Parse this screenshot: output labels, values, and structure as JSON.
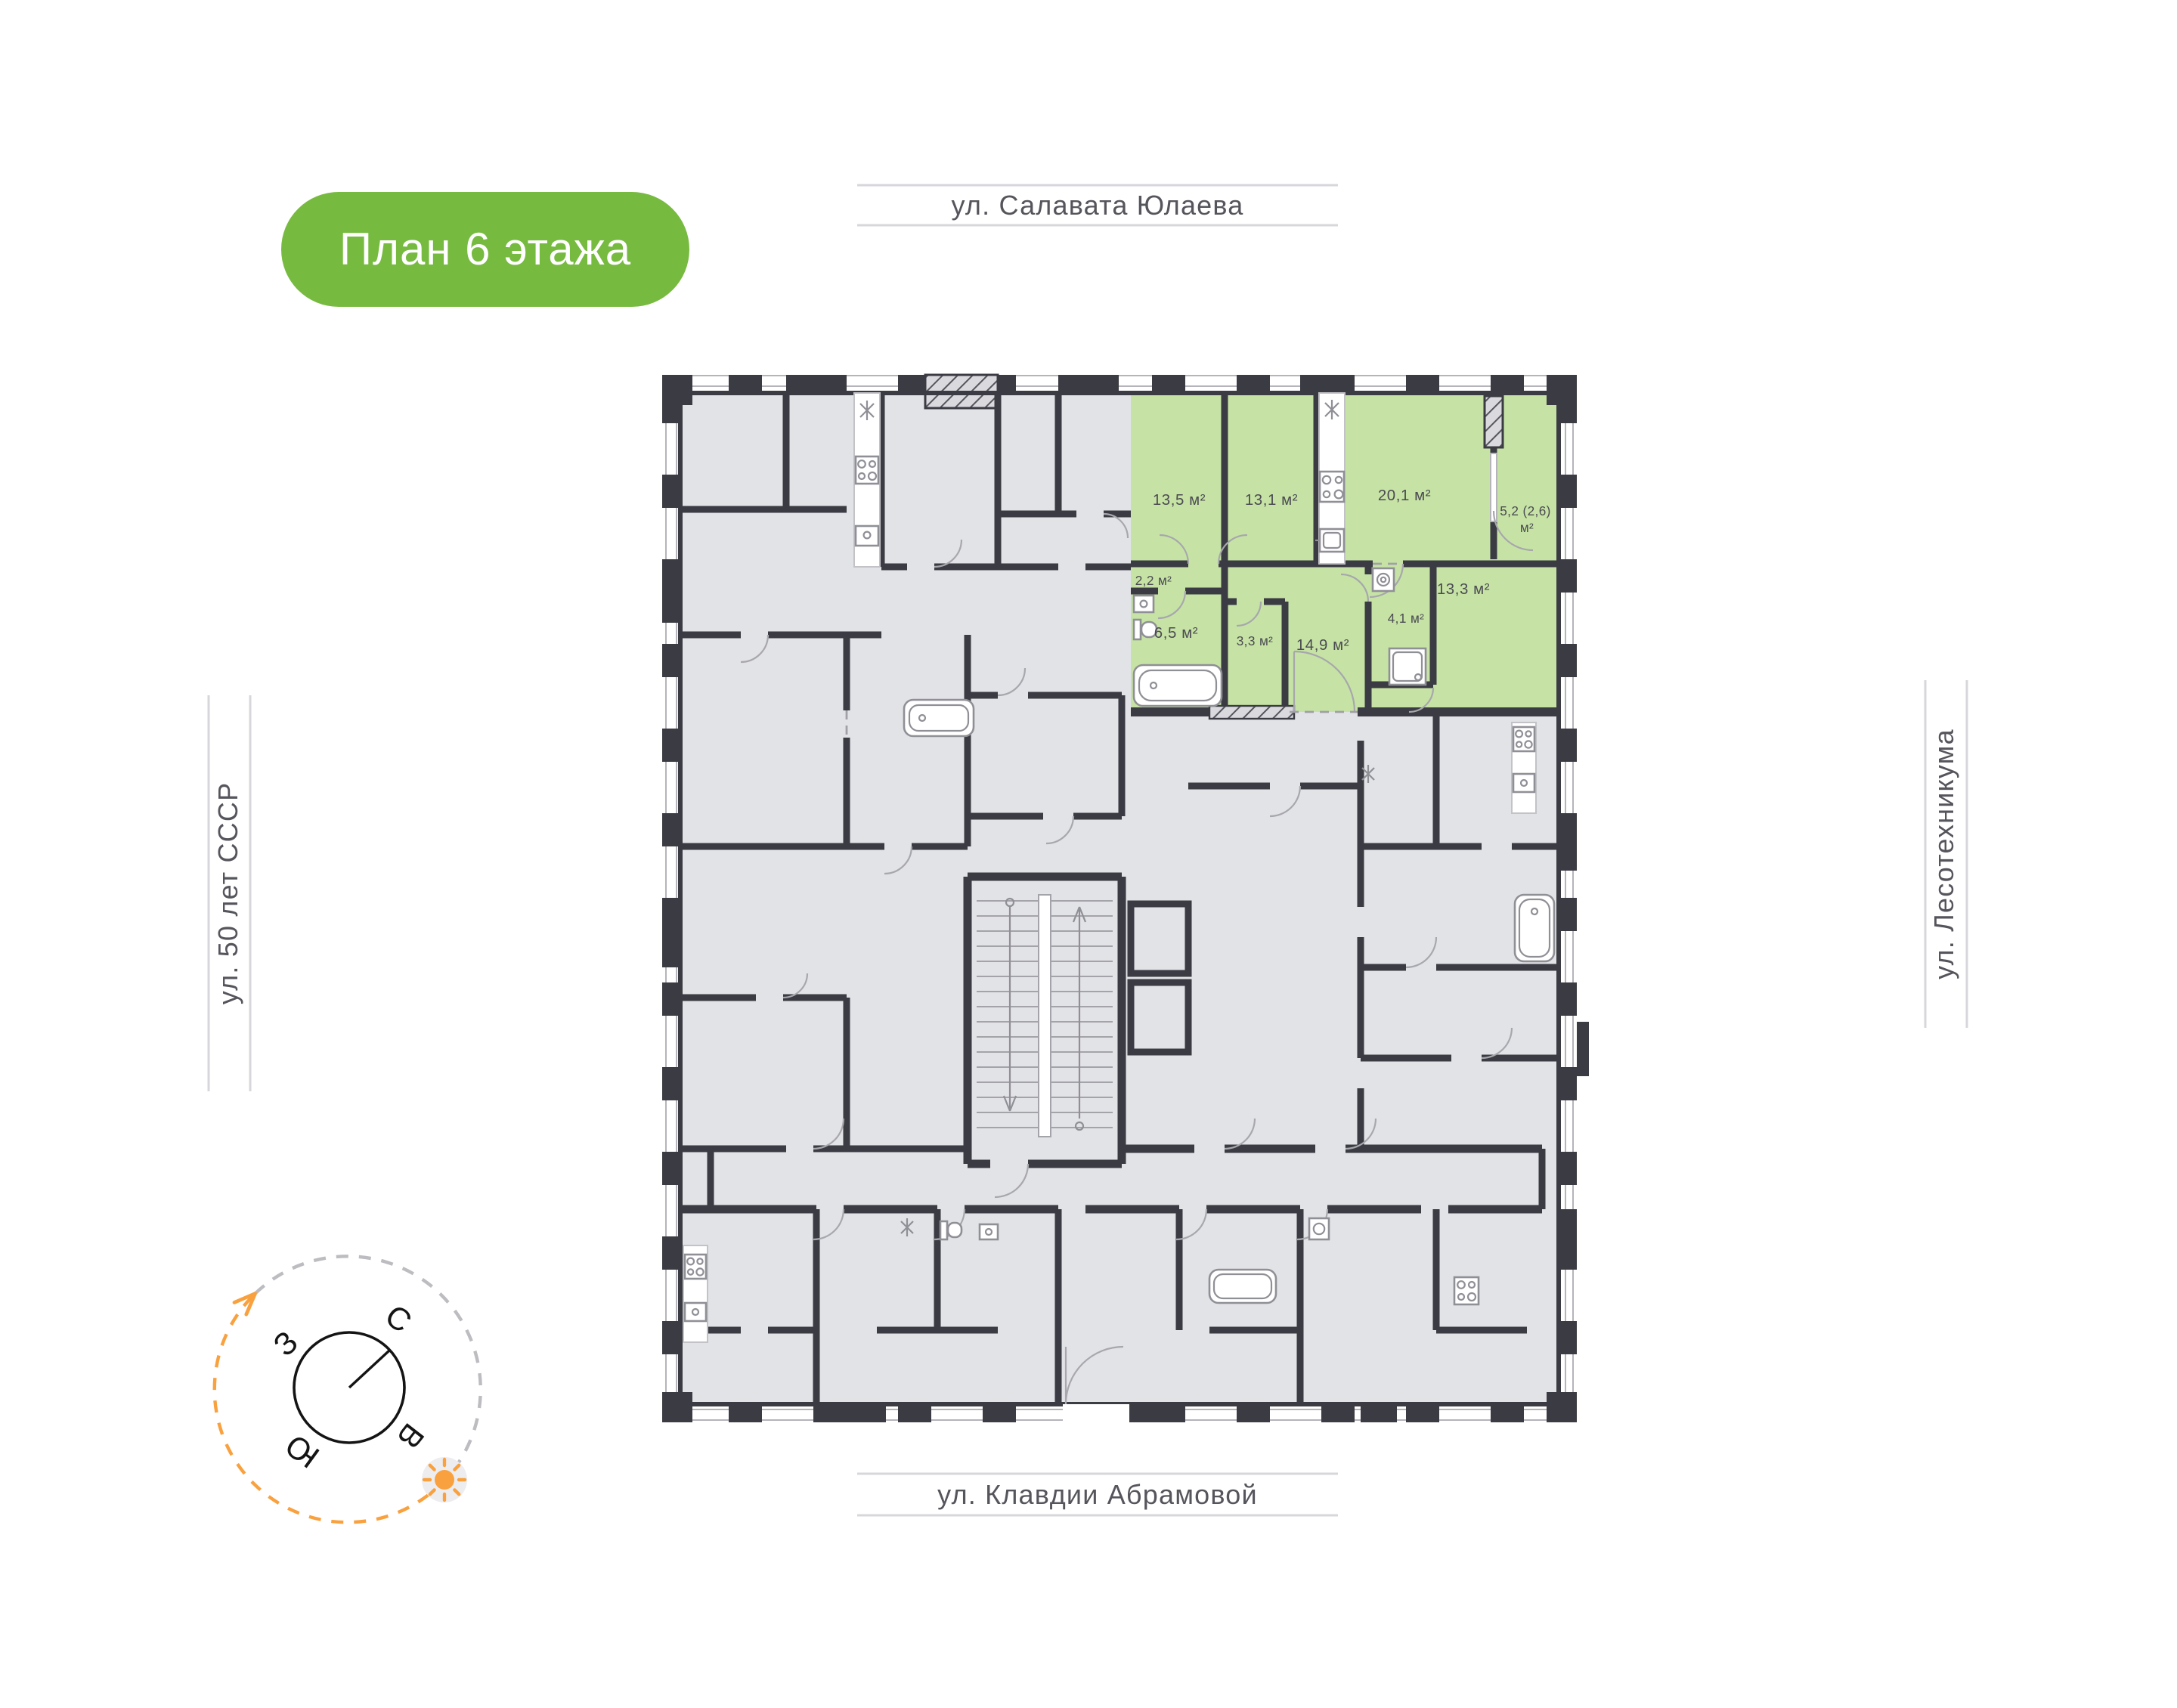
{
  "badge": {
    "label": "План 6 этажа"
  },
  "streets": {
    "top": "ул. Салавата Юлаева",
    "bottom": "ул. Клавдии Абрамовой",
    "left": "ул. 50 лет СССР",
    "right": "ул. Лесотехникума"
  },
  "compass": {
    "north": "С",
    "east": "В",
    "south": "Ю",
    "west": "З"
  },
  "apartment": {
    "rooms": [
      {
        "name": "bedroom-13-5",
        "area": "13,5 м²"
      },
      {
        "name": "bedroom-13-1",
        "area": "13,1 м²"
      },
      {
        "name": "kitchen-living-20-1",
        "area": "20,1 м²"
      },
      {
        "name": "loggia-5-2",
        "area_line1": "5,2 (2,6)",
        "area_line2": "м²"
      },
      {
        "name": "hallway-2-2",
        "area": "2,2 м²"
      },
      {
        "name": "room-13-3",
        "area": "13,3 м²"
      },
      {
        "name": "bathroom-6-5",
        "area": "6,5 м²"
      },
      {
        "name": "wc-3-3",
        "area": "3,3 м²"
      },
      {
        "name": "hall-14-9",
        "area": "14,9 м²"
      },
      {
        "name": "utility-4-1",
        "area": "4,1 м²"
      }
    ]
  },
  "colors": {
    "highlight_green": "#c6e3a5",
    "badge_green": "#77ba40",
    "wall_dark": "#3b3b43",
    "room_gray": "#e2e3e7",
    "accent_orange": "#f9a13e"
  }
}
